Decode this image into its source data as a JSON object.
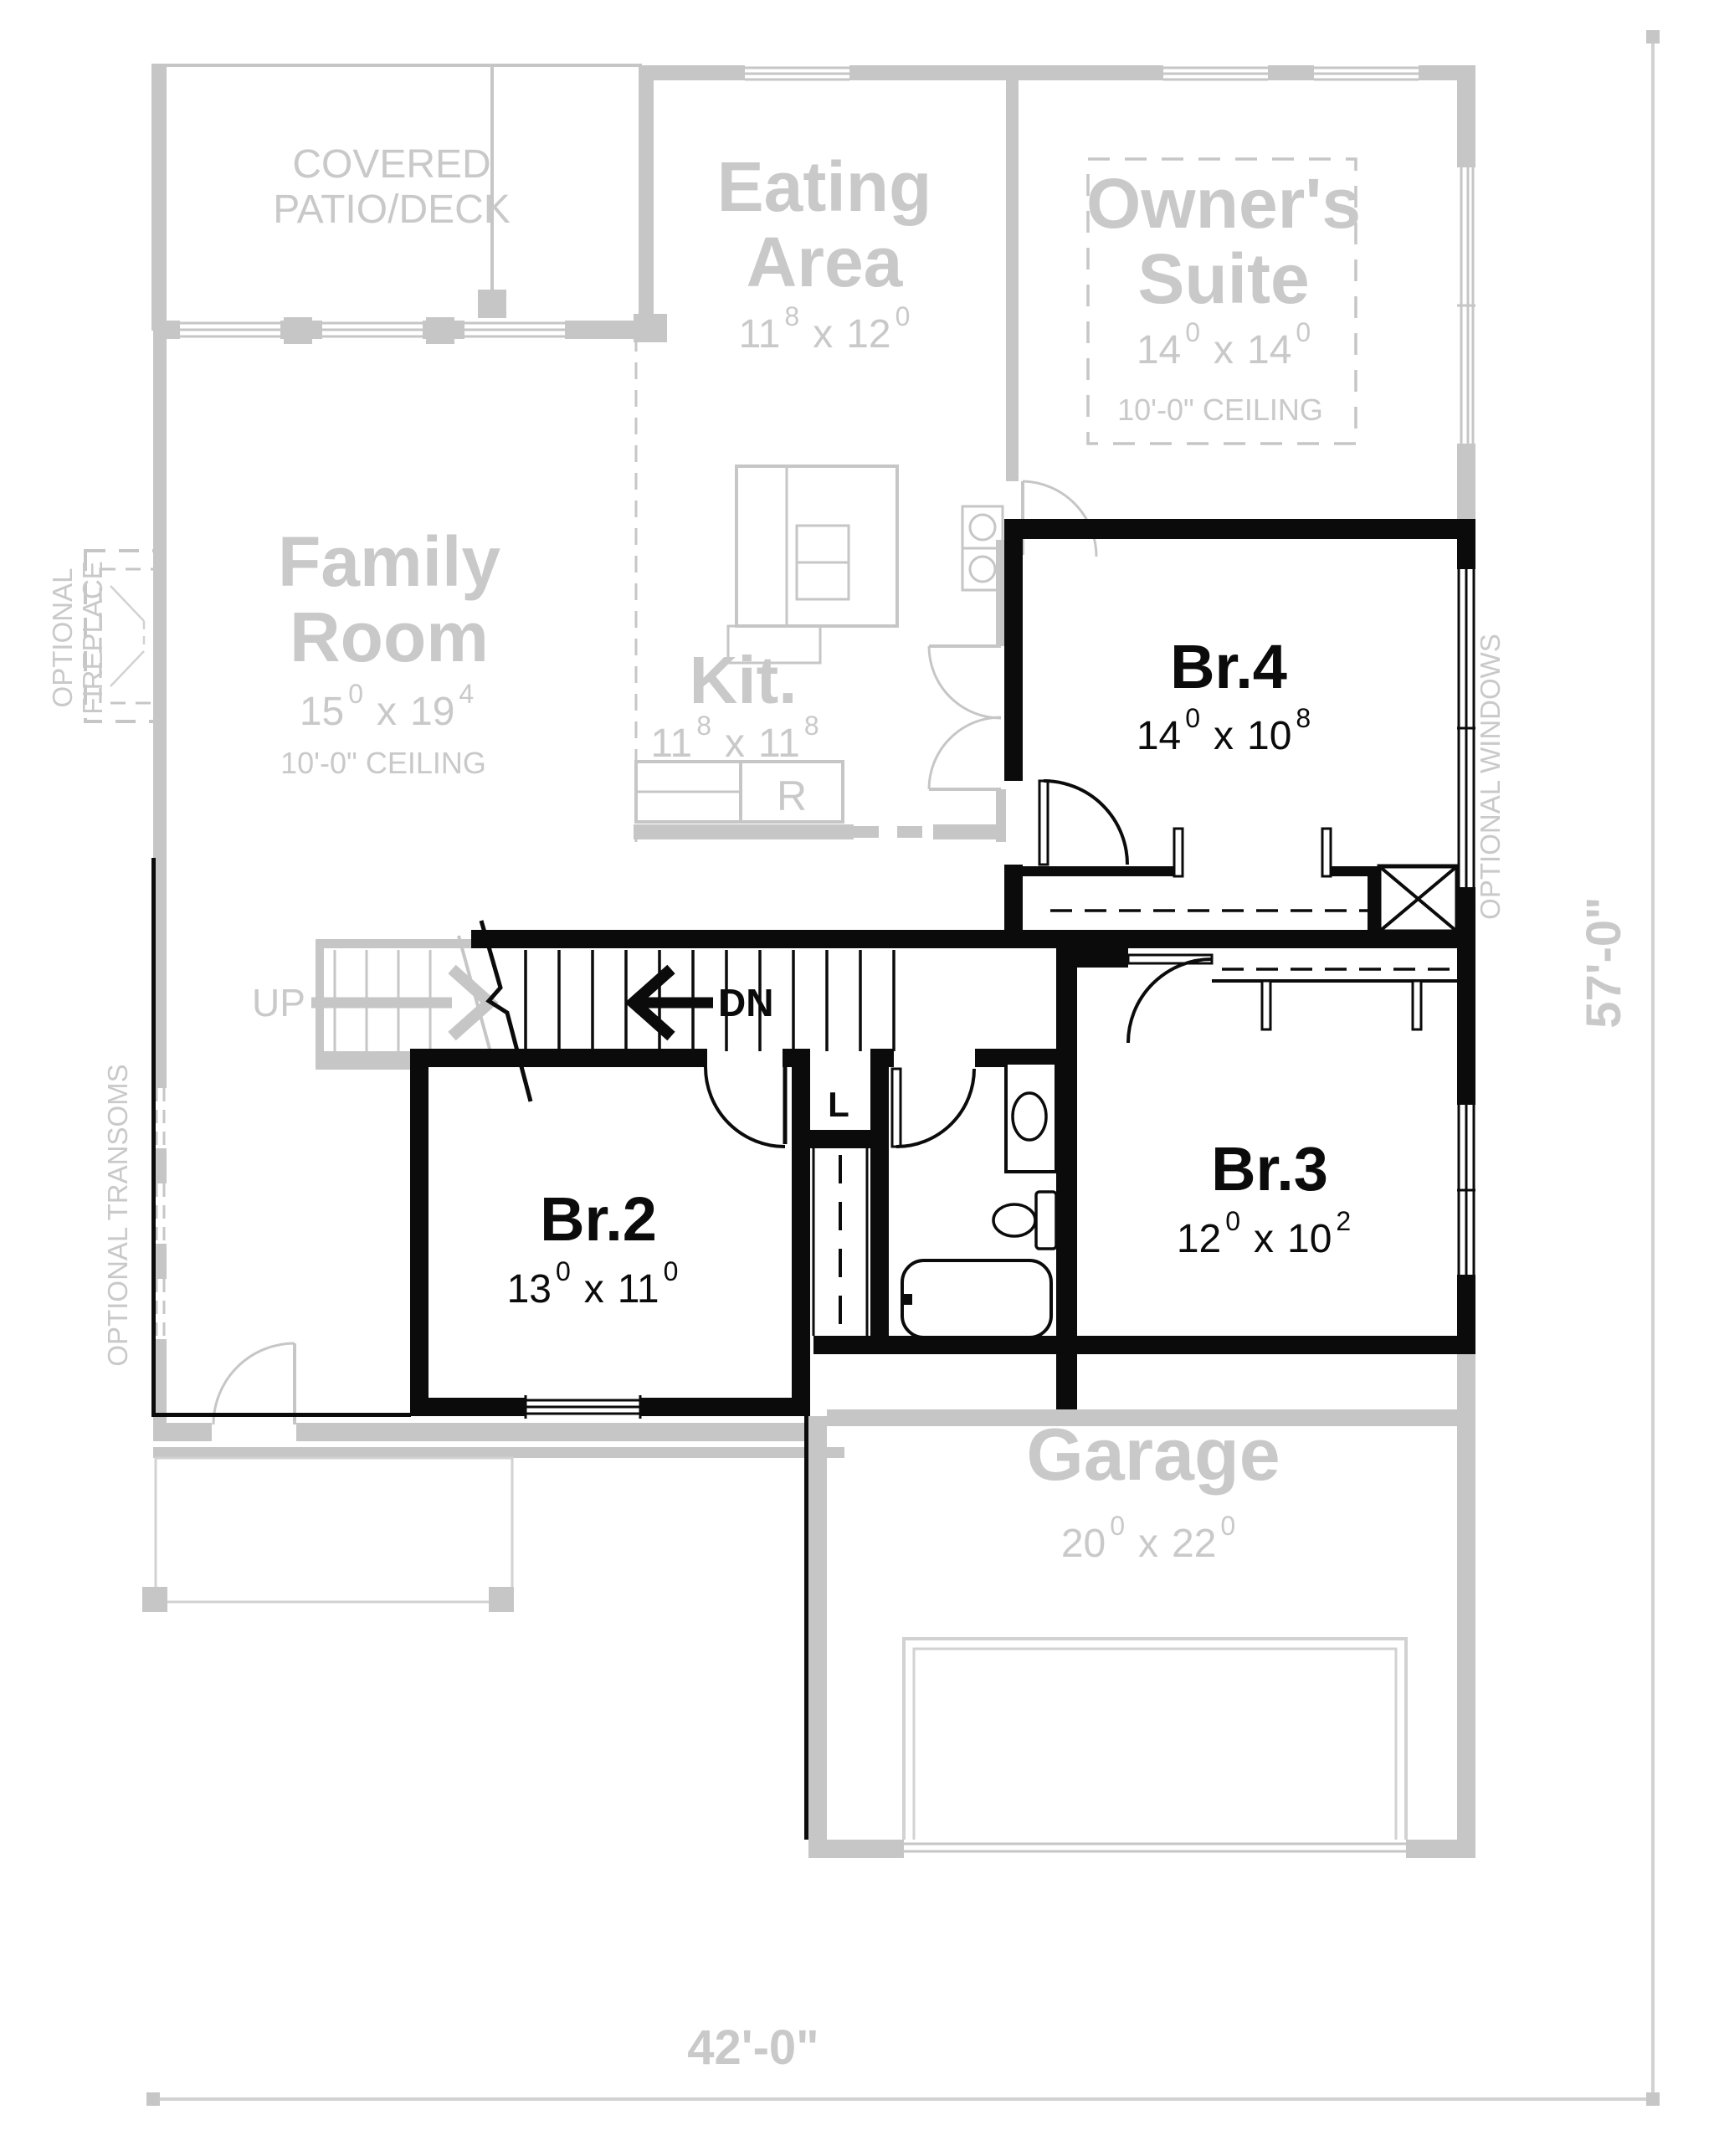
{
  "plan_type": "floor-plan",
  "colors": {
    "first_floor": "#c6c6c6",
    "second_floor": "#0b0b0b",
    "gray_text": "#c9c9c9",
    "background": "#ffffff"
  },
  "labels": {
    "up": "UP",
    "dn": "DN",
    "linen": "L",
    "fridge": "R",
    "optional_fireplace_line1": "OPTIONAL",
    "optional_fireplace_line2": "FIREPLACE",
    "optional_transoms": "OPTIONAL TRANSOMS",
    "optional_windows": "OPTIONAL WINDOWS",
    "dim_width": "42'-0\"",
    "dim_height": "57'-0\""
  },
  "rooms": {
    "patio": {
      "line1": "COVERED",
      "line2": "PATIO/DECK"
    },
    "eating": {
      "line1": "Eating",
      "line2": "Area",
      "dim": {
        "a": "11",
        "as": "8",
        "sep": "x",
        "b": "12",
        "bs": "0"
      }
    },
    "owners": {
      "line1": "Owner's",
      "line2": "Suite",
      "dim": {
        "a": "14",
        "as": "0",
        "sep": "x",
        "b": "14",
        "bs": "0"
      },
      "ceiling": "10'-0\" CEILING"
    },
    "family": {
      "line1": "Family",
      "line2": "Room",
      "dim": {
        "a": "15",
        "as": "0",
        "sep": "x",
        "b": "19",
        "bs": "4"
      },
      "ceiling": "10'-0\" CEILING"
    },
    "kitchen": {
      "name": "Kit.",
      "dim": {
        "a": "11",
        "as": "8",
        "sep": "x",
        "b": "11",
        "bs": "8"
      }
    },
    "garage": {
      "name": "Garage",
      "dim": {
        "a": "20",
        "as": "0",
        "sep": "x",
        "b": "22",
        "bs": "0"
      }
    },
    "br2": {
      "name": "Br.2",
      "dim": {
        "a": "13",
        "as": "0",
        "sep": "x",
        "b": "11",
        "bs": "0"
      }
    },
    "br3": {
      "name": "Br.3",
      "dim": {
        "a": "12",
        "as": "0",
        "sep": "x",
        "b": "10",
        "bs": "2"
      }
    },
    "br4": {
      "name": "Br.4",
      "dim": {
        "a": "14",
        "as": "0",
        "sep": "x",
        "b": "10",
        "bs": "8"
      }
    }
  }
}
